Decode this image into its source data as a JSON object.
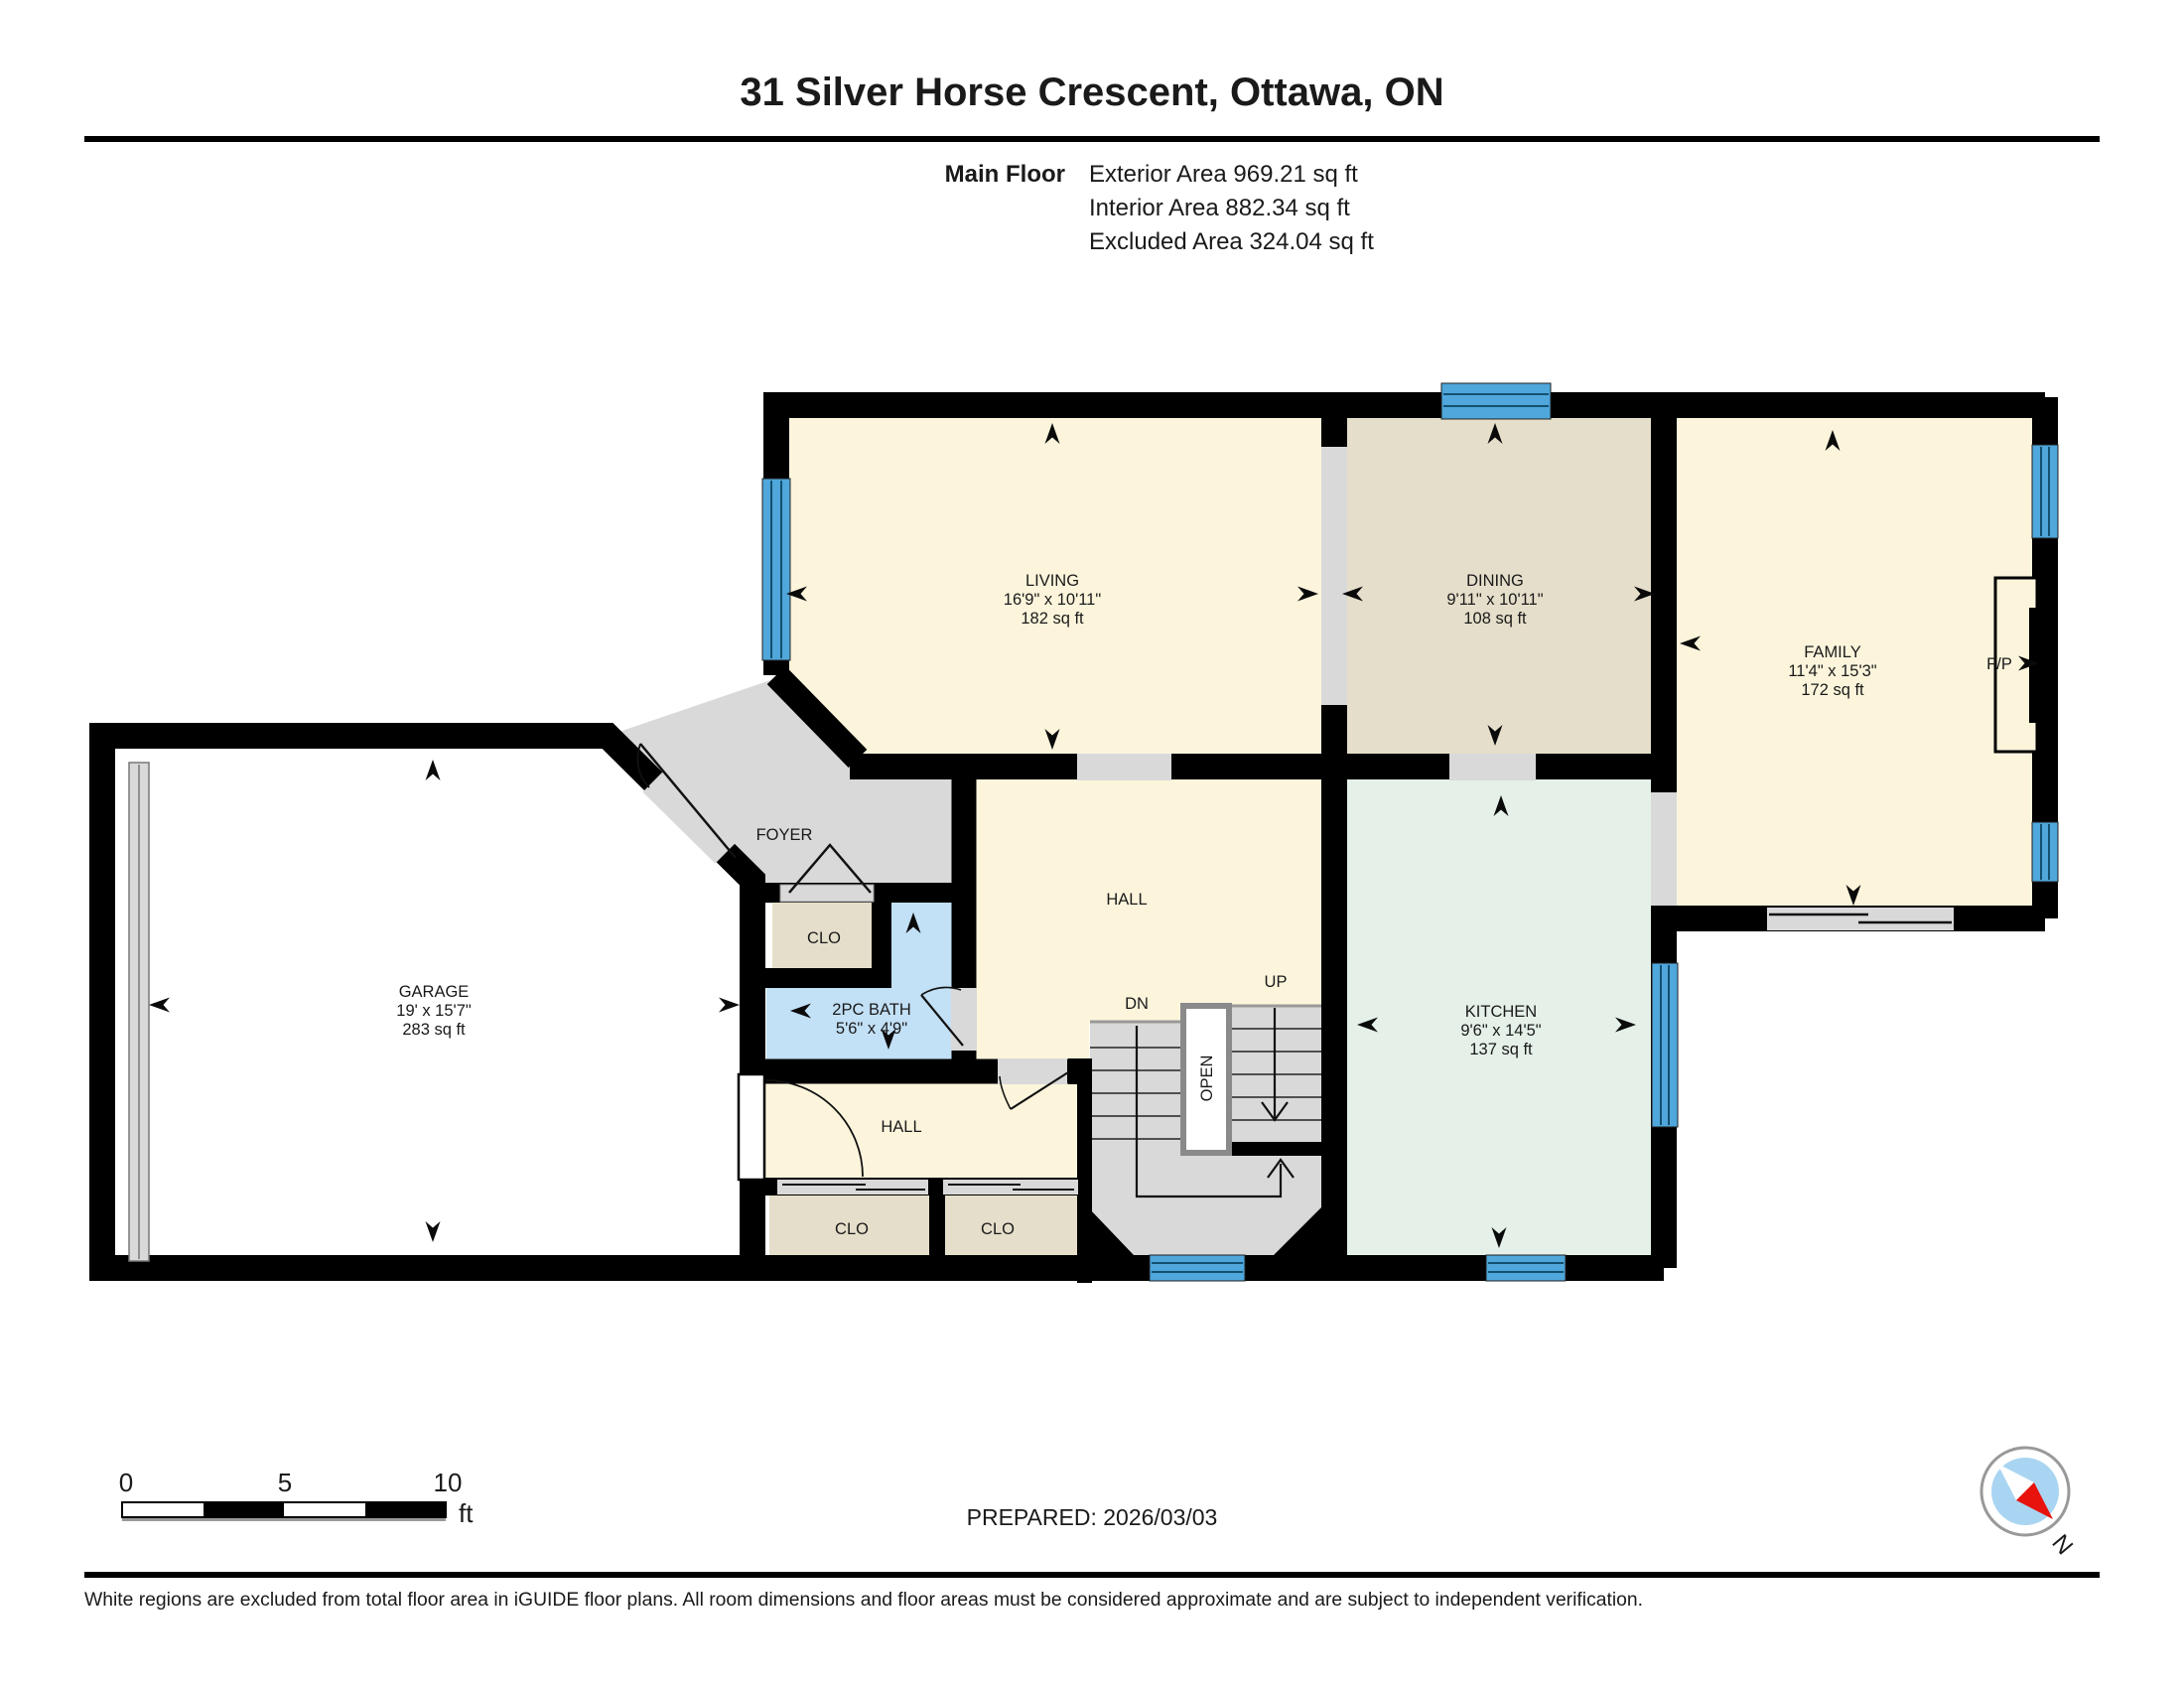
{
  "header": {
    "title": "31 Silver Horse Crescent, Ottawa, ON",
    "floor_label": "Main Floor",
    "exterior": "Exterior Area 969.21 sq ft",
    "interior": "Interior Area 882.34 sq ft",
    "excluded": "Excluded Area 324.04 sq ft"
  },
  "rooms": {
    "living": {
      "name": "LIVING",
      "dims": "16'9\" x 10'11\"",
      "area": "182 sq ft"
    },
    "dining": {
      "name": "DINING",
      "dims": "9'11\" x 10'11\"",
      "area": "108 sq ft"
    },
    "family": {
      "name": "FAMILY",
      "dims": "11'4\" x 15'3\"",
      "area": "172 sq ft"
    },
    "kitchen": {
      "name": "KITCHEN",
      "dims": "9'6\" x 14'5\"",
      "area": "137 sq ft"
    },
    "garage": {
      "name": "GARAGE",
      "dims": "19' x 15'7\"",
      "area": "283 sq ft"
    },
    "bath": {
      "name": "2PC BATH",
      "dims": "5'6\" x 4'9\""
    }
  },
  "labels": {
    "foyer": "FOYER",
    "hall_upper": "HALL",
    "hall_lower": "HALL",
    "clo_foyer": "CLO",
    "clo_left": "CLO",
    "clo_right": "CLO",
    "up": "UP",
    "dn": "DN",
    "open": "OPEN",
    "fireplace": "F/P",
    "north": "N"
  },
  "scale_bar": {
    "zero": "0",
    "five": "5",
    "ten": "10",
    "unit": "ft"
  },
  "footer": {
    "prepared": "PREPARED: 2026/03/03",
    "disclaimer": "White regions are excluded from total floor area in iGUIDE floor plans. All room dimensions and floor areas must be considered approximate and are subject to independent verification."
  },
  "colors": {
    "room_cream": "#FCF5DC",
    "room_tan": "#E5DECA",
    "room_mint": "#E4F0E8",
    "room_bath_blue": "#C2E0F6",
    "floor_gray": "#D9D9D9",
    "window_blue": "#4FA7DB",
    "window_stripe": "#14506F",
    "wall_black": "#000000",
    "compass_blue": "#A9D5F2",
    "compass_red": "#E8130C"
  }
}
